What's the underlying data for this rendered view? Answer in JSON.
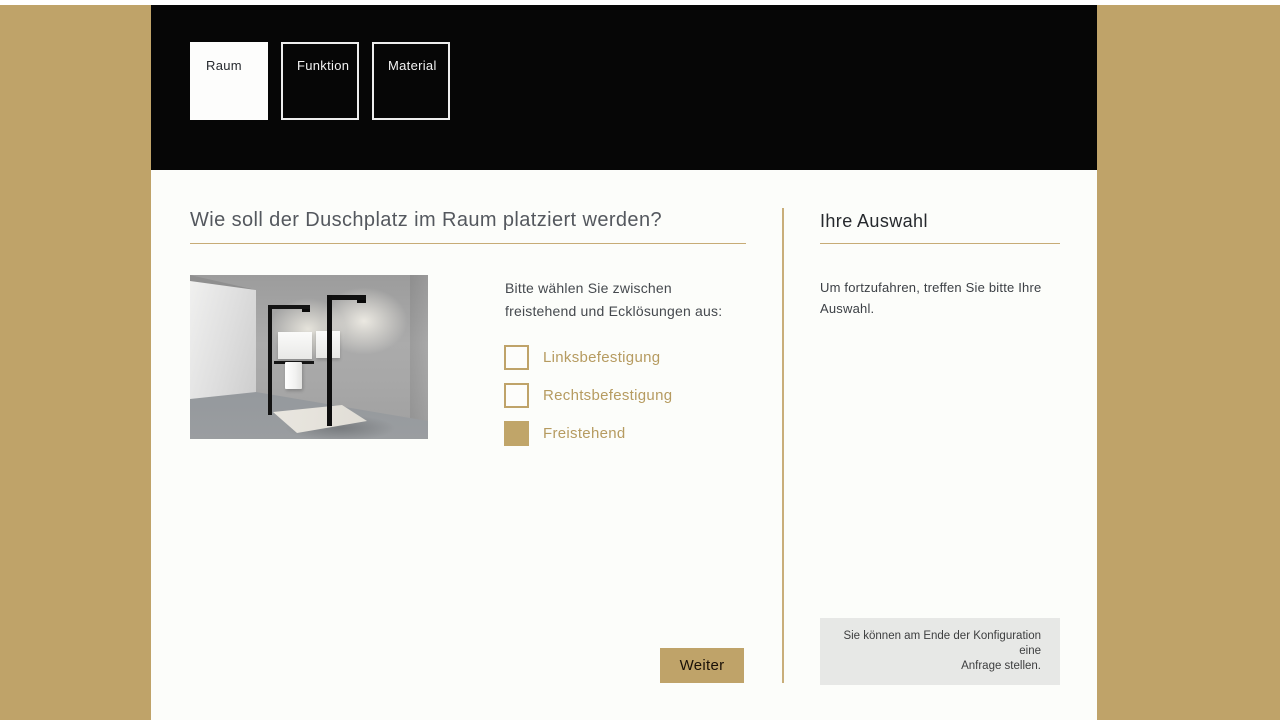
{
  "colors": {
    "accent_gold": "#bfa369",
    "header_black": "#060606",
    "content_white": "#fcfdfa",
    "option_text_gold": "#b69b60",
    "note_box_gray": "#e7e8e6"
  },
  "header": {
    "tabs": [
      {
        "label": "Raum",
        "active": true
      },
      {
        "label": "Funktion",
        "active": false
      },
      {
        "label": "Material",
        "active": false
      }
    ]
  },
  "main": {
    "question": "Wie soll der Duschplatz im Raum platziert werden?",
    "image_alt": "freistehende-duschwand-vorschau",
    "intro": "Bitte wählen Sie zwischen\nfreistehend und Ecklösungen aus:",
    "options": [
      {
        "label": "Linksbefestigung",
        "checked": false
      },
      {
        "label": "Rechtsbefestigung",
        "checked": false
      },
      {
        "label": "Freistehend",
        "checked": true
      }
    ],
    "next_button": "Weiter"
  },
  "selection_panel": {
    "title": "Ihre Auswahl",
    "empty_hint": "Um fortzufahren, treffen Sie bitte Ihre\nAuswahl.",
    "note": "Sie können am Ende der Konfiguration eine\nAnfrage stellen."
  }
}
